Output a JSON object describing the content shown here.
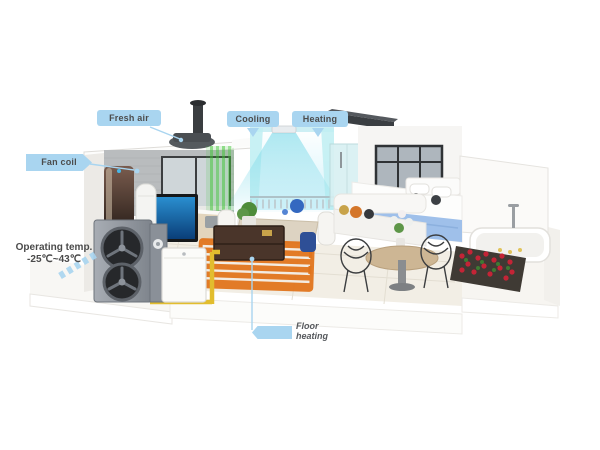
{
  "labels": {
    "fresh_air": "Fresh air",
    "cooling": "Cooling",
    "heating": "Heating",
    "fan_coil": "Fan coil",
    "operating_line1": "Operating temp.",
    "operating_line2": "-25℃~43℃",
    "floor_line1": "Floor",
    "floor_line2": "heating"
  },
  "colors": {
    "background": "#ffffff",
    "callout_blue": "#a9d5f0",
    "label_text": "#4c4c4c",
    "pipe_yellow": "#e2bd2e",
    "floor_coil_orange": "#e0741c",
    "cool_air_cyan": "#7ad9e8",
    "fresh_air_green": "#3fc435",
    "outdoor_unit_gray": "#8d939b",
    "fan_grille_dark": "#26282b",
    "blanket_blue": "#9fc0ea",
    "flower_red": "#c42436"
  }
}
